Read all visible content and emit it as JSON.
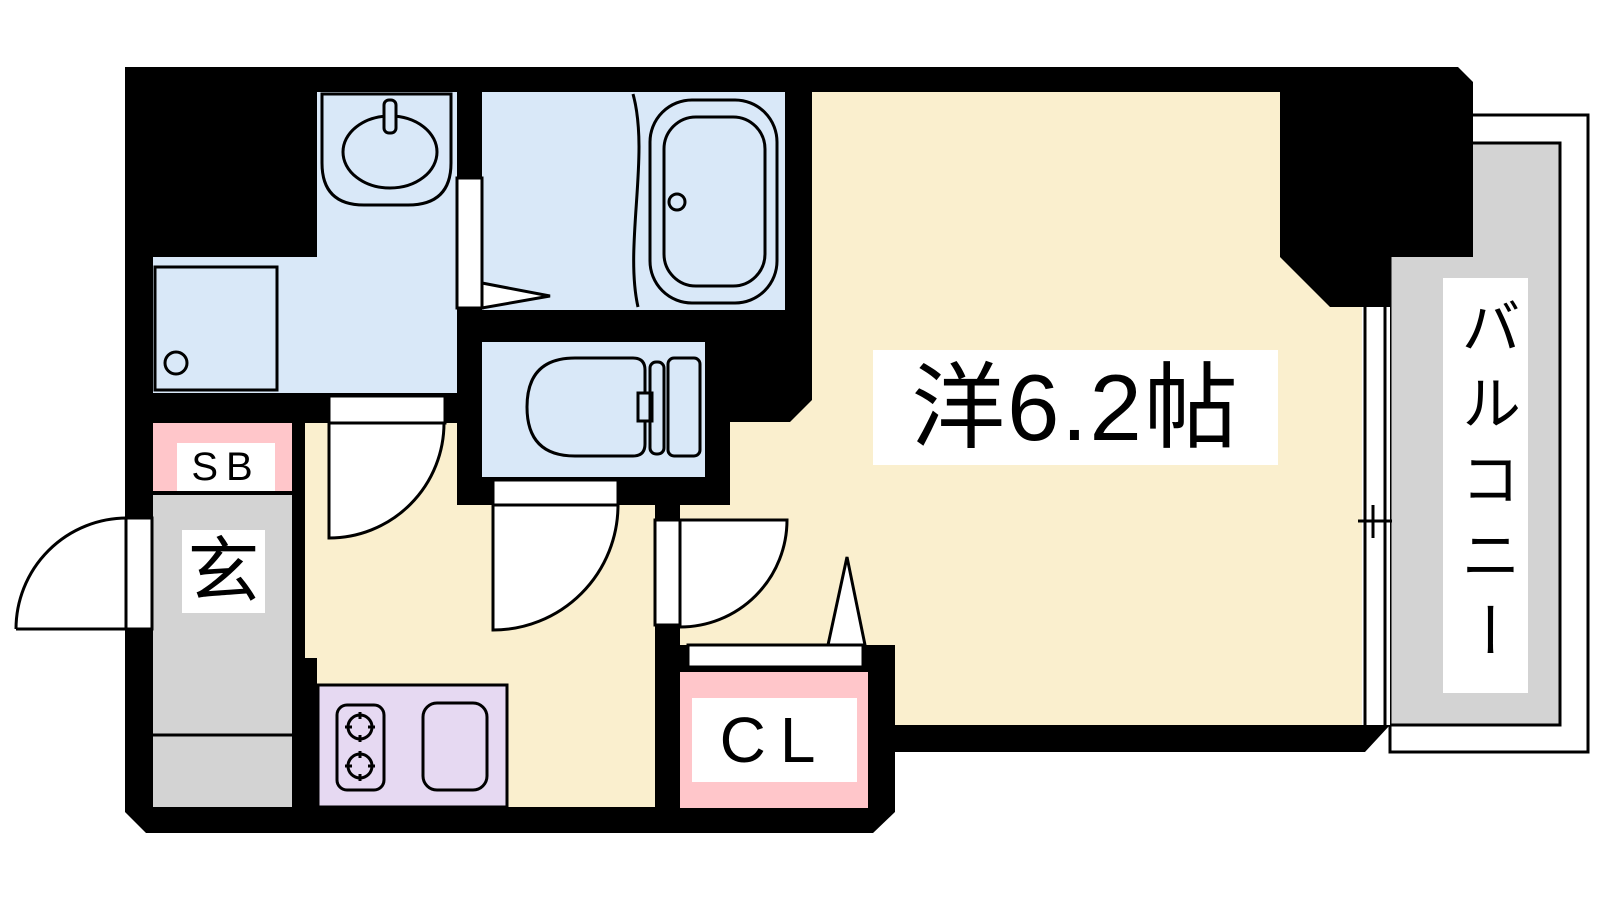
{
  "floorplan": {
    "rooms": {
      "main_room": {
        "label": "洋6.2帖"
      },
      "balcony": {
        "label": "バルコニー"
      },
      "entrance": {
        "label": "玄"
      },
      "shoe_box": {
        "label": "SB"
      },
      "closet": {
        "label": "CL"
      }
    },
    "colors": {
      "wall": "#000000",
      "wet_area": "#D9E8F8",
      "living": "#FAEFCE",
      "balcony_floor": "#D3D3D3",
      "entrance_floor": "#D3D3D3",
      "storage": "#FFC6CA",
      "kitchen_counter": "#E6D9F2",
      "label_bg": "#FFFFFF",
      "line": "#000000"
    }
  }
}
